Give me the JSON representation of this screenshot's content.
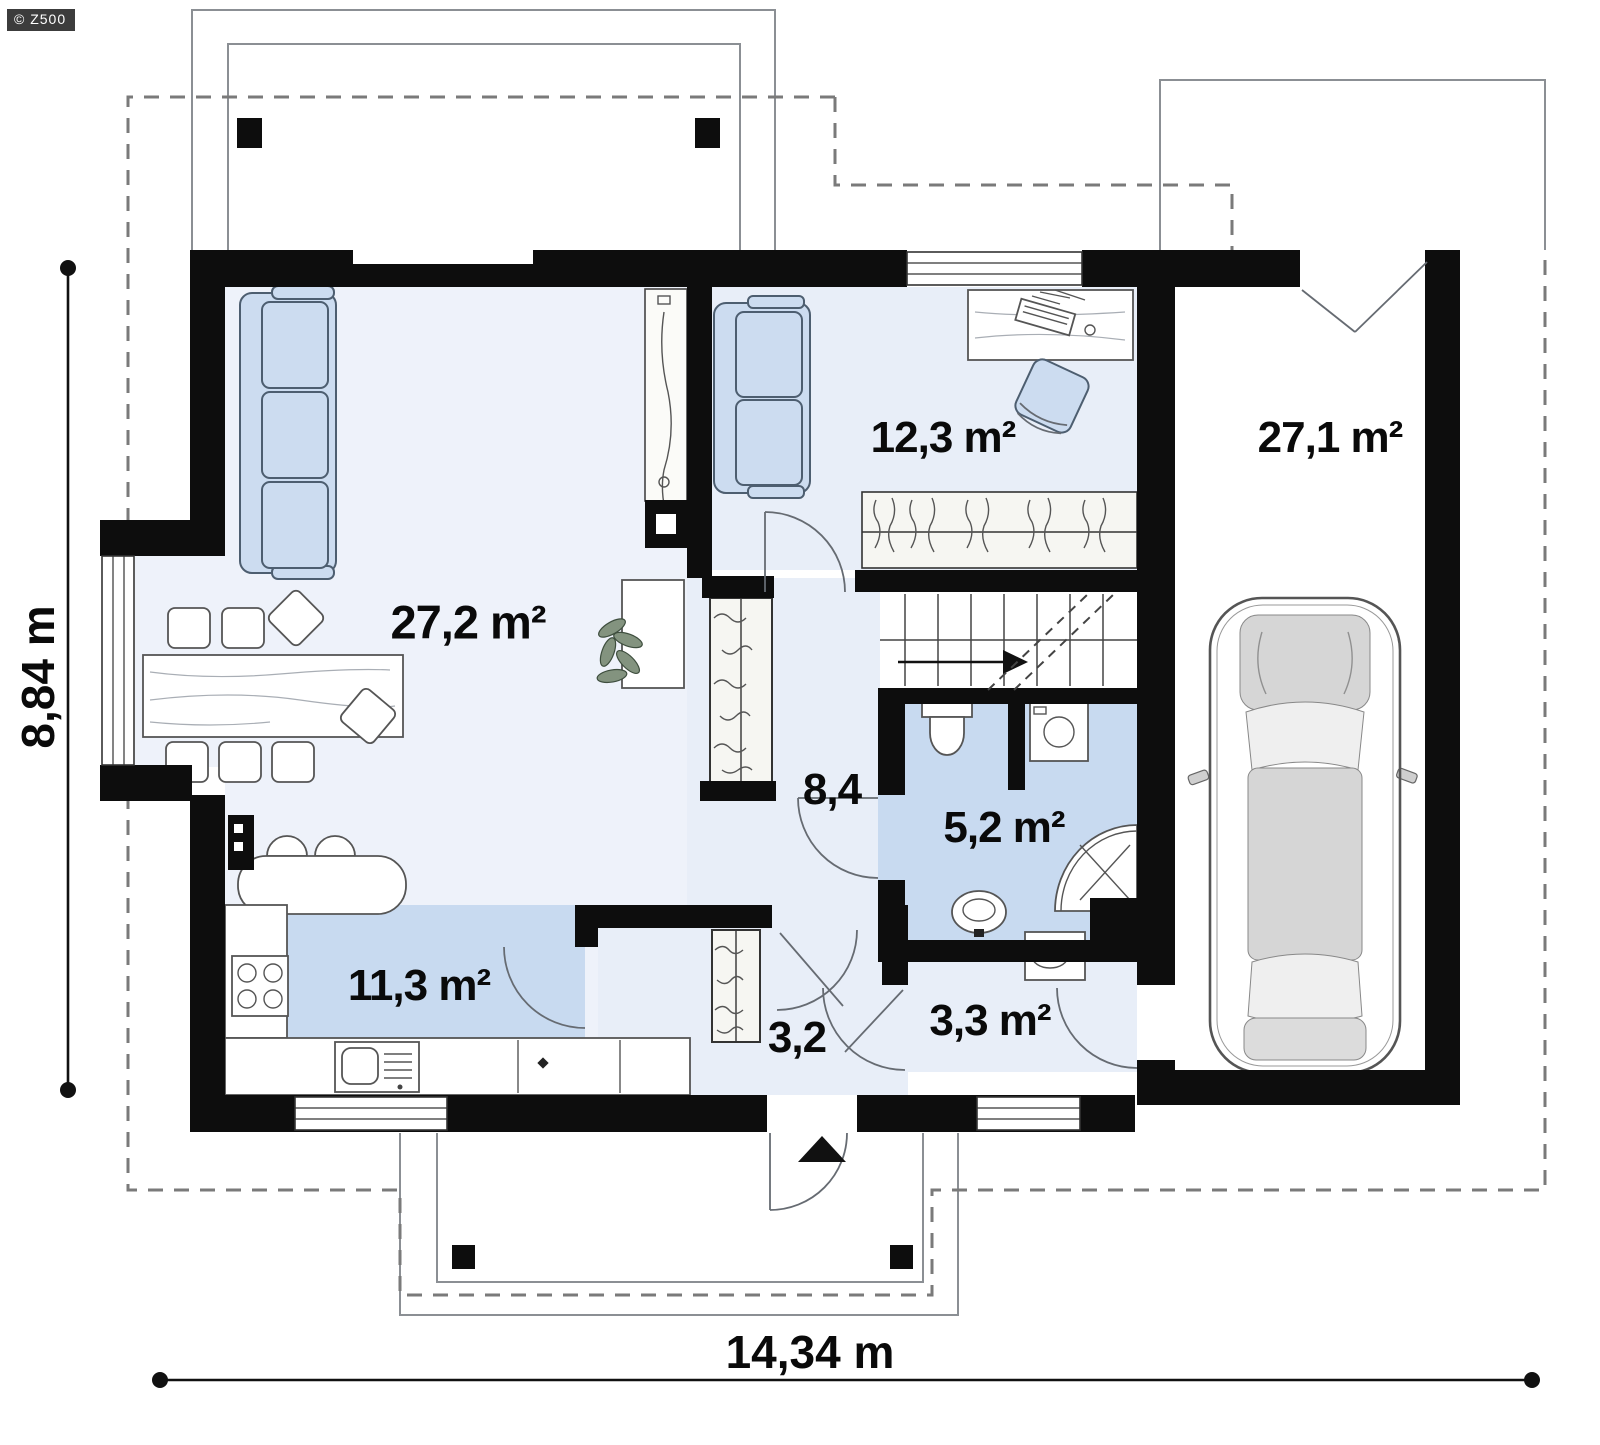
{
  "watermark": {
    "label": "© Z500"
  },
  "rooms": {
    "living": {
      "label": "27,2 m²"
    },
    "office": {
      "label": "12,3 m²"
    },
    "garage": {
      "label": "27,1 m²"
    },
    "hall": {
      "label": "8,4"
    },
    "bathroom": {
      "label": "5,2 m²"
    },
    "kitchen": {
      "label": "11,3 m²"
    },
    "vestibule": {
      "label": "3,2"
    },
    "storage": {
      "label": "3,3 m²"
    }
  },
  "dimensions": {
    "overall_width": "14,34 m",
    "overall_height": "8,84 m"
  },
  "colors": {
    "wall": "#0d0d0d",
    "floor-light": "#eef2fa",
    "floor-pale": "#e8eef8",
    "floor-blue": "#c8daf0",
    "furn-blue": "#ccdcf0",
    "furn-edge": "#4d5e70",
    "line": "#555555",
    "dash": "#7a7a7a",
    "label-color": "#0a0a0a",
    "watermark-bg": "#3c3c3c"
  }
}
